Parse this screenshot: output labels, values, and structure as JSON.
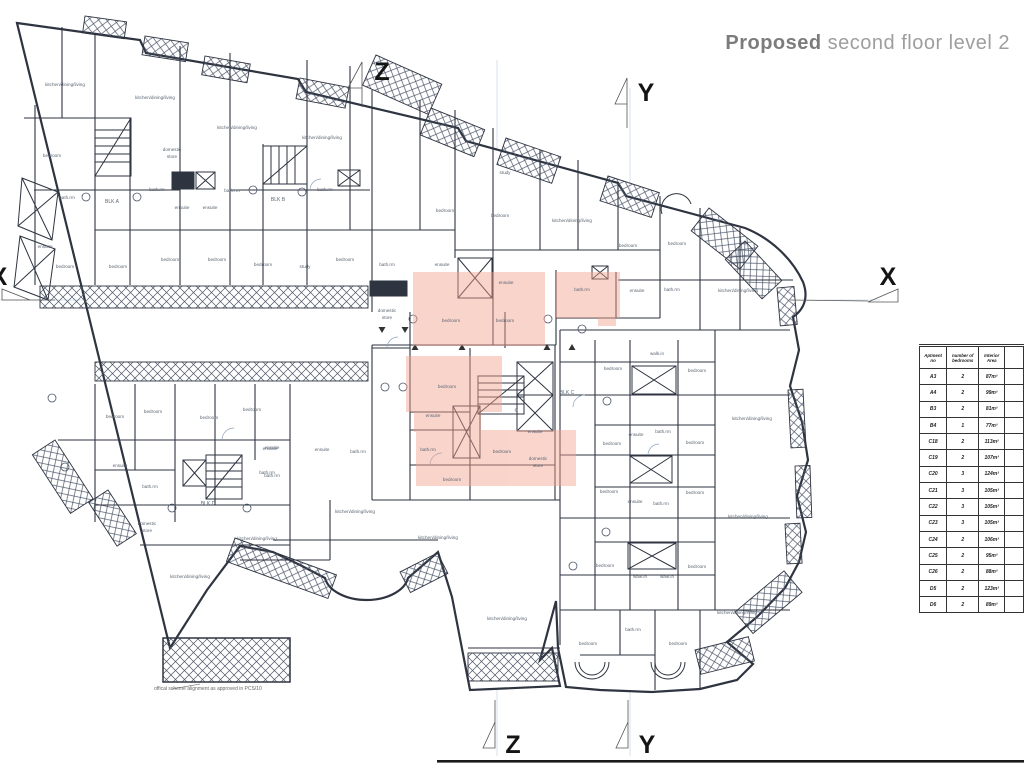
{
  "title": {
    "bold": "Proposed",
    "regular": " second floor level 2"
  },
  "note": "offical scheme alignment as approved in PCS/10",
  "watermark": {
    "letter": "G",
    "color": "#ee9884"
  },
  "colors": {
    "wall": "#2e3440",
    "light_line": "#a9c0d6",
    "highlight": "#f2a28e",
    "text": "#5b6673"
  },
  "table": {
    "headers": [
      "Aptment  no",
      "number of bedrooms",
      "Interior Area"
    ],
    "rows": [
      [
        "A3",
        "2",
        "87m²"
      ],
      [
        "A4",
        "2",
        "99m²"
      ],
      [
        "B3",
        "2",
        "81m²"
      ],
      [
        "B4",
        "1",
        "77m²"
      ],
      [
        "C18",
        "2",
        "113m²"
      ],
      [
        "C19",
        "2",
        "107m²"
      ],
      [
        "C20",
        "3",
        "124m²"
      ],
      [
        "C21",
        "3",
        "105m²"
      ],
      [
        "C22",
        "3",
        "105m²"
      ],
      [
        "C23",
        "3",
        "105m²"
      ],
      [
        "C24",
        "2",
        "106m²"
      ],
      [
        "C25",
        "2",
        "95m²"
      ],
      [
        "C26",
        "2",
        "88m²"
      ],
      [
        "D5",
        "2",
        "123m²"
      ],
      [
        "D6",
        "2",
        "89m²"
      ]
    ]
  },
  "plan": {
    "section_markers": [
      {
        "label": "Z",
        "position": "top"
      },
      {
        "label": "Y",
        "position": "top"
      },
      {
        "label": "X",
        "position": "right"
      },
      {
        "label": "X",
        "position": "left"
      },
      {
        "label": "Z",
        "position": "bottom"
      },
      {
        "label": "Y",
        "position": "bottom"
      }
    ],
    "room_labels": [
      {
        "t": "kitchen/dining/living",
        "x": 65,
        "y": 86
      },
      {
        "t": "kitchen/dining/living",
        "x": 155,
        "y": 99
      },
      {
        "t": "kitchen/dining/living",
        "x": 237,
        "y": 129
      },
      {
        "t": "kitchen/dining/living",
        "x": 322,
        "y": 139
      },
      {
        "t": "bedroom",
        "x": 52,
        "y": 157
      },
      {
        "t": "domestic",
        "x": 172,
        "y": 151
      },
      {
        "t": "store",
        "x": 172,
        "y": 158
      },
      {
        "t": "bath.rm",
        "x": 67,
        "y": 199
      },
      {
        "t": "bath.rm",
        "x": 157,
        "y": 191
      },
      {
        "t": "bath.rm",
        "x": 232,
        "y": 192
      },
      {
        "t": "bath.rm",
        "x": 325,
        "y": 191
      },
      {
        "t": "BLK A",
        "x": 112,
        "y": 203,
        "s": 5,
        "c": "#333"
      },
      {
        "t": "BLK B",
        "x": 278,
        "y": 201,
        "s": 5,
        "c": "#333"
      },
      {
        "t": "ensuite",
        "x": 182,
        "y": 209
      },
      {
        "t": "ensuite",
        "x": 210,
        "y": 209
      },
      {
        "t": "ensuite",
        "x": 45,
        "y": 248
      },
      {
        "t": "bedroom",
        "x": 65,
        "y": 268
      },
      {
        "t": "bedroom",
        "x": 118,
        "y": 268
      },
      {
        "t": "bedroom",
        "x": 170,
        "y": 261
      },
      {
        "t": "bedroom",
        "x": 217,
        "y": 261
      },
      {
        "t": "bedroom",
        "x": 263,
        "y": 266
      },
      {
        "t": "study",
        "x": 305,
        "y": 268
      },
      {
        "t": "bedroom",
        "x": 345,
        "y": 261
      },
      {
        "t": "study",
        "x": 505,
        "y": 174
      },
      {
        "t": "bedroom",
        "x": 445,
        "y": 212
      },
      {
        "t": "bedroom",
        "x": 500,
        "y": 217
      },
      {
        "t": "kitchen/dining/living",
        "x": 572,
        "y": 222
      },
      {
        "t": "bedroom",
        "x": 628,
        "y": 247
      },
      {
        "t": "bedroom",
        "x": 677,
        "y": 245
      },
      {
        "t": "ensuite",
        "x": 637,
        "y": 292
      },
      {
        "t": "bath.rm",
        "x": 672,
        "y": 291
      },
      {
        "t": "kitchen/dining/living",
        "x": 738,
        "y": 292
      },
      {
        "t": "bath.rm",
        "x": 387,
        "y": 266
      },
      {
        "t": "ensuite",
        "x": 442,
        "y": 266
      },
      {
        "t": "ensuite",
        "x": 506,
        "y": 284
      },
      {
        "t": "bath.rm",
        "x": 582,
        "y": 291
      },
      {
        "t": "domestic",
        "x": 387,
        "y": 312
      },
      {
        "t": "store",
        "x": 387,
        "y": 319
      },
      {
        "t": "bedroom",
        "x": 451,
        "y": 322
      },
      {
        "t": "bedroom",
        "x": 505,
        "y": 322
      },
      {
        "t": "bedroom",
        "x": 447,
        "y": 388
      },
      {
        "t": "BLK C",
        "x": 567,
        "y": 394,
        "s": 5,
        "c": "#333"
      },
      {
        "t": "ensuite",
        "x": 433,
        "y": 417
      },
      {
        "t": "bath.rm",
        "x": 428,
        "y": 451
      },
      {
        "t": "bedroom",
        "x": 502,
        "y": 453
      },
      {
        "t": "ensuite",
        "x": 535,
        "y": 433
      },
      {
        "t": "domestic",
        "x": 538,
        "y": 460
      },
      {
        "t": "store",
        "x": 538,
        "y": 467
      },
      {
        "t": "bedroom",
        "x": 452,
        "y": 481
      },
      {
        "t": "walk.in",
        "x": 657,
        "y": 355
      },
      {
        "t": "bedroom",
        "x": 613,
        "y": 370
      },
      {
        "t": "bedroom",
        "x": 697,
        "y": 372
      },
      {
        "t": "kitchen/dining/living",
        "x": 752,
        "y": 420
      },
      {
        "t": "ensuite",
        "x": 636,
        "y": 436
      },
      {
        "t": "bath.rm",
        "x": 663,
        "y": 433
      },
      {
        "t": "bedroom",
        "x": 612,
        "y": 445
      },
      {
        "t": "bedroom",
        "x": 695,
        "y": 444
      },
      {
        "t": "bedroom",
        "x": 609,
        "y": 493
      },
      {
        "t": "bedroom",
        "x": 695,
        "y": 494
      },
      {
        "t": "ensuite",
        "x": 635,
        "y": 503
      },
      {
        "t": "bath.rm",
        "x": 661,
        "y": 505
      },
      {
        "t": "kitchen/dining/living",
        "x": 748,
        "y": 518
      },
      {
        "t": "bedroom",
        "x": 605,
        "y": 567
      },
      {
        "t": "bedroom",
        "x": 697,
        "y": 568
      },
      {
        "t": "walk.in",
        "x": 640,
        "y": 578
      },
      {
        "t": "walk.in",
        "x": 667,
        "y": 578
      },
      {
        "t": "kitchen/dining/living",
        "x": 737,
        "y": 614
      },
      {
        "t": "bath.rm",
        "x": 633,
        "y": 631
      },
      {
        "t": "bedroom",
        "x": 588,
        "y": 645
      },
      {
        "t": "bedroom",
        "x": 678,
        "y": 645
      },
      {
        "t": "bedroom",
        "x": 115,
        "y": 418
      },
      {
        "t": "bedroom",
        "x": 153,
        "y": 413
      },
      {
        "t": "bedroom",
        "x": 209,
        "y": 419
      },
      {
        "t": "bedroom",
        "x": 252,
        "y": 411
      },
      {
        "t": "ensuite",
        "x": 120,
        "y": 467
      },
      {
        "t": "ensuite",
        "x": 272,
        "y": 449
      },
      {
        "t": "bath.rm",
        "x": 150,
        "y": 488
      },
      {
        "t": "bath.rm",
        "x": 272,
        "y": 477
      },
      {
        "t": "BLK D",
        "x": 208,
        "y": 505,
        "s": 5,
        "c": "#333"
      },
      {
        "t": "domestic",
        "x": 147,
        "y": 525
      },
      {
        "t": "store",
        "x": 147,
        "y": 532
      },
      {
        "t": "kitchen/dining/living",
        "x": 257,
        "y": 540
      },
      {
        "t": "kitchen/dining/living",
        "x": 190,
        "y": 578
      },
      {
        "t": "ensuite",
        "x": 270,
        "y": 450
      },
      {
        "t": "ensuite",
        "x": 322,
        "y": 451
      },
      {
        "t": "bath.rm",
        "x": 358,
        "y": 453
      },
      {
        "t": "bath.rm",
        "x": 267,
        "y": 474
      },
      {
        "t": "kitchen/dining/living",
        "x": 355,
        "y": 513
      },
      {
        "t": "kitchen/dining/living",
        "x": 438,
        "y": 539
      },
      {
        "t": "kitchen/dining/living",
        "x": 507,
        "y": 620
      }
    ]
  }
}
